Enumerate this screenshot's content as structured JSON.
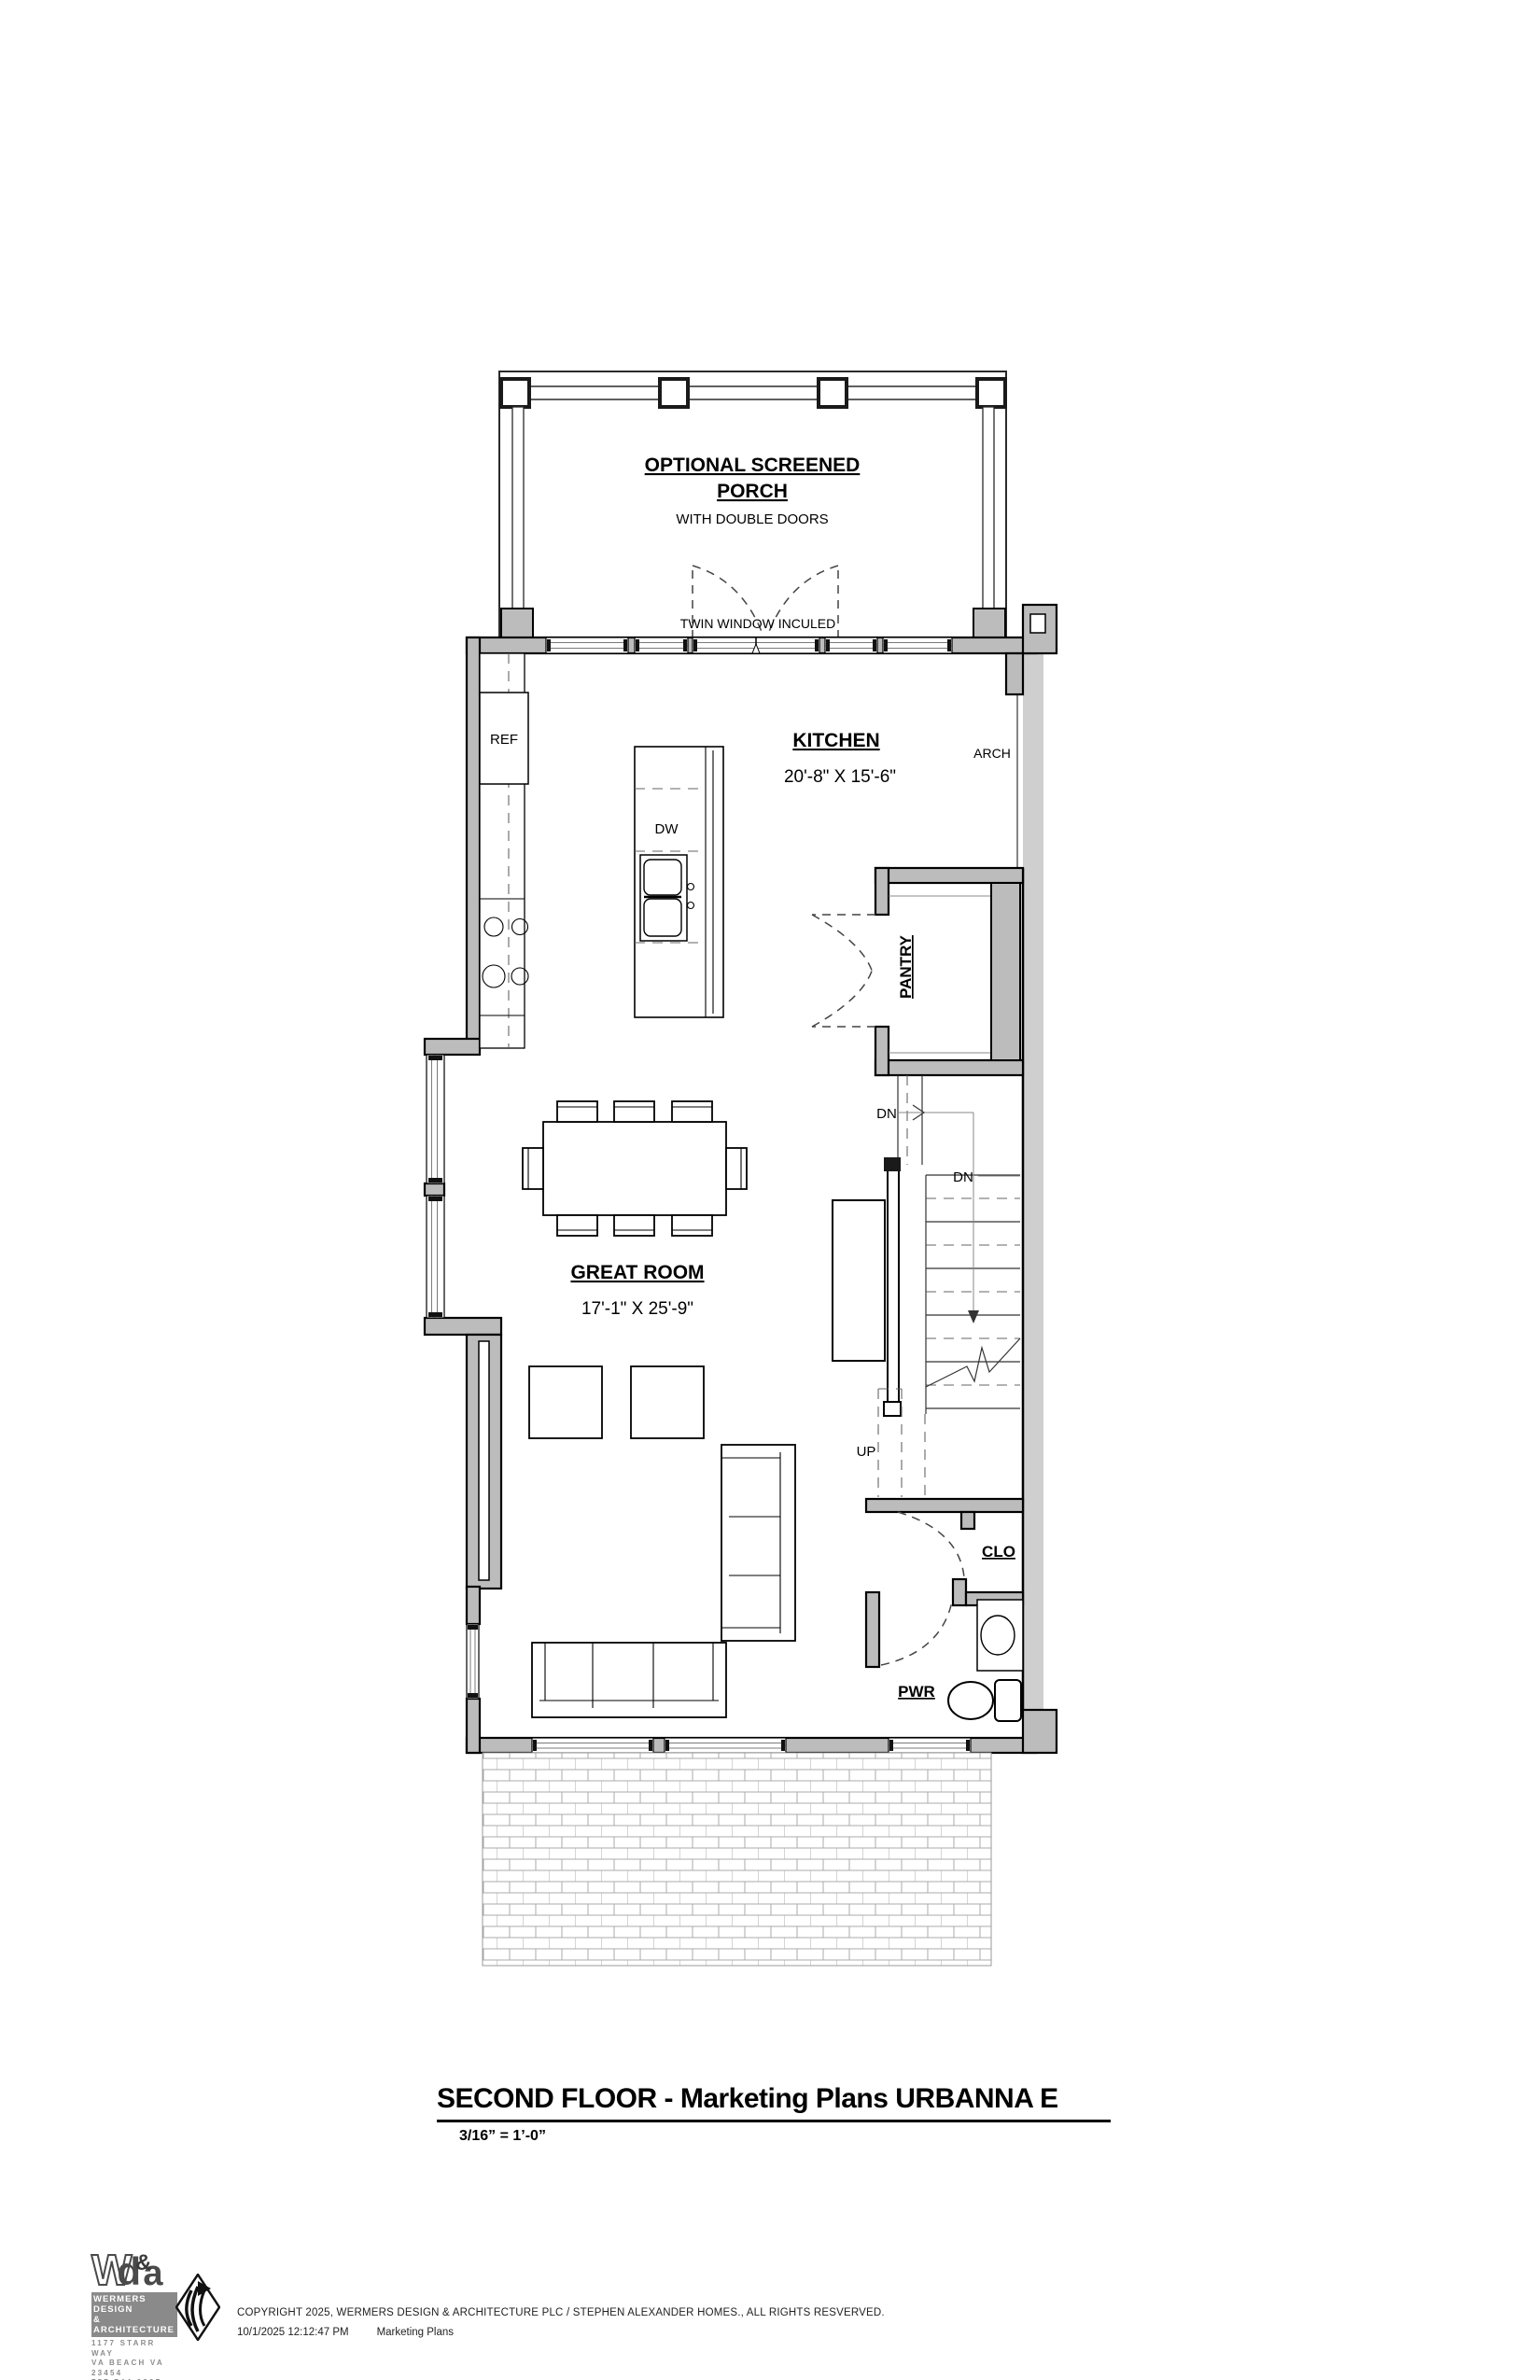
{
  "sheet": {
    "title": "SECOND FLOOR - Marketing Plans URBANNA E",
    "scale": "3/16” = 1’-0”"
  },
  "porch": {
    "title_line1": "OPTIONAL SCREENED",
    "title_line2": "PORCH",
    "subtitle": "WITH DOUBLE DOORS",
    "window_note": "TWIN WINDOW INCULED"
  },
  "rooms": {
    "kitchen": {
      "name": "KITCHEN",
      "dimensions": "20'-8\" X 15'-6\""
    },
    "great_room": {
      "name": "GREAT ROOM",
      "dimensions": "17'-1\" X 25'-9\""
    },
    "pantry": {
      "name": "PANTRY"
    },
    "closet": {
      "name": "CLO"
    },
    "powder": {
      "name": "PWR"
    }
  },
  "labels": {
    "ref": "REF",
    "dw": "DW",
    "arch": "ARCH",
    "dn_upper": "DN",
    "dn_lower": "DN",
    "up": "UP"
  },
  "branding": {
    "logo_w": "W",
    "logo_d": "d",
    "logo_amp": "&",
    "logo_a": "a",
    "firm_line1": "WERMERS DESIGN",
    "firm_line2": "& ARCHITECTURE",
    "address_line1": "1177 STARR WAY",
    "address_line2": "VA BEACH VA 23454",
    "phone": "757.744.9327"
  },
  "footer": {
    "copyright": "COPYRIGHT 2025, WERMERS DESIGN & ARCHITECTURE PLC / STEPHEN ALEXANDER HOMES., ALL RIGHTS RESVERVED.",
    "timestamp": "10/1/2025 12:12:47 PM",
    "document": "Marketing Plans"
  },
  "colors": {
    "wall_fill": "#bcbcbc",
    "party_wall_fill": "#cfcfcf",
    "line": "#000000"
  }
}
